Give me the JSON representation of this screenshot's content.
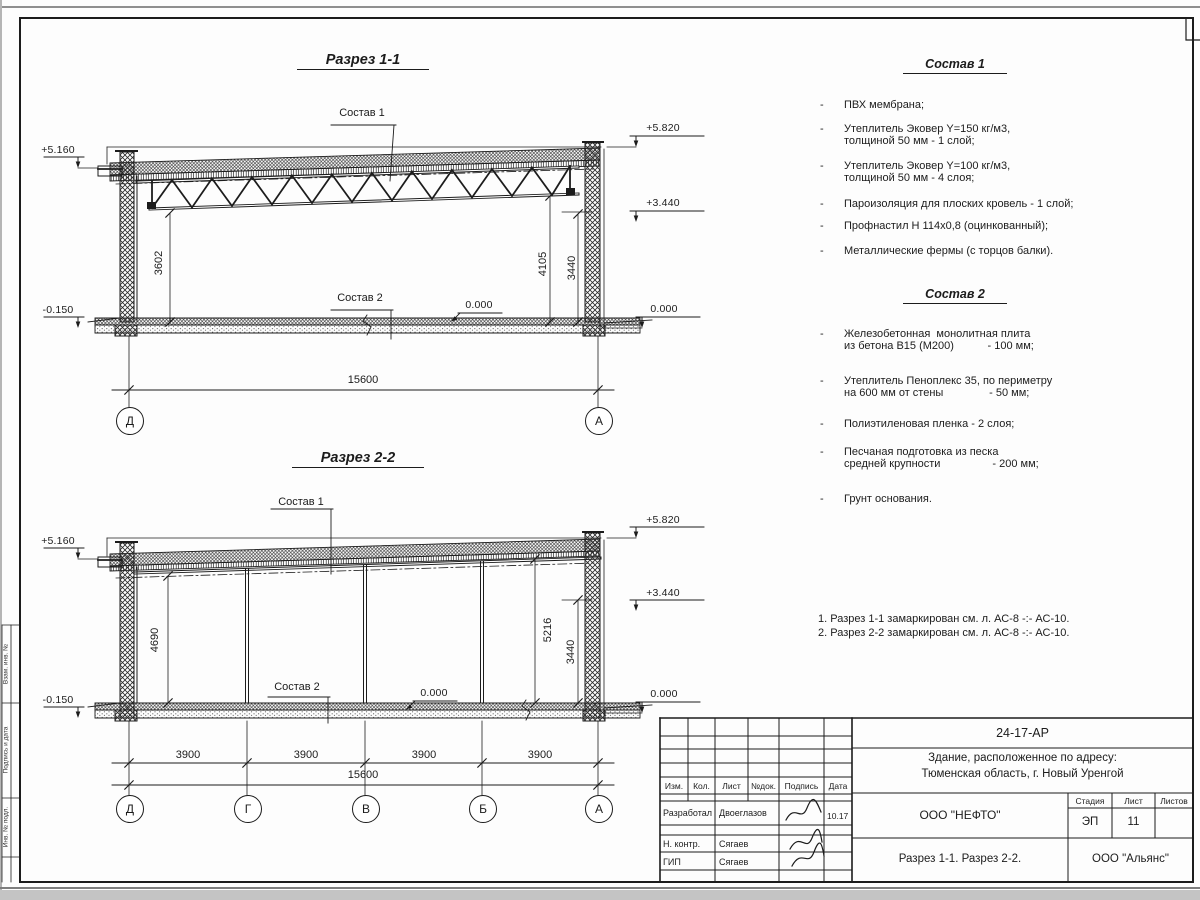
{
  "frame": {
    "side_labels": [
      "Взам. инв. №",
      "Подпись и дата",
      "Инв. № подл."
    ]
  },
  "section1": {
    "title": "Разрез 1-1",
    "sostav1_label": "Состав 1",
    "sostav2_label": "Состав 2",
    "elev_parapet": "+5.160",
    "elev_top": "+5.820",
    "elev_mid": "+3.440",
    "elev_zero": "0.000",
    "elev_floor": "0.000",
    "elev_ground": "-0.150",
    "dim_left": "3602",
    "dim_right_a": "4105",
    "dim_right_b": "3440",
    "dim_total": "15600",
    "axes": [
      "Д",
      "А"
    ]
  },
  "section2": {
    "title": "Разрез 2-2",
    "sostav1_label": "Состав 1",
    "sostav2_label": "Состав 2",
    "elev_parapet": "+5.160",
    "elev_top": "+5.820",
    "elev_mid": "+3.440",
    "elev_zero": "0.000",
    "elev_floor": "0.000",
    "elev_ground": "-0.150",
    "dim_left": "4690",
    "dim_right_a": "5216",
    "dim_right_b": "3440",
    "spans": [
      "3900",
      "3900",
      "3900",
      "3900"
    ],
    "dim_total": "15600",
    "axes": [
      "Д",
      "Г",
      "В",
      "Б",
      "А"
    ]
  },
  "lists": {
    "bullet": "-",
    "sostav1": {
      "title": "Состав 1",
      "items": [
        "ПВХ мембрана;",
        "Утеплитель Эковер Y=150 кг/м3,\nтолщиной 50 мм - 1 слой;",
        "Утеплитель Эковер Y=100 кг/м3,\nтолщиной 50 мм - 4 слоя;",
        "Пароизоляция для плоских кровель - 1 слой;",
        "Профнастил Н 114х0,8 (оцинкованный);",
        "Металлические фермы (с торцов балки)."
      ]
    },
    "sostav2": {
      "title": "Состав 2",
      "items": [
        "Железобетонная  монолитная плита\nиз бетона В15 (М200)           - 100 мм;",
        "Утеплитель Пеноплекс 35, по периметру\nна 600 мм от стены               - 50 мм;",
        "Полиэтиленовая пленка - 2 слоя;",
        "Песчаная подготовка из песка\nсредней крупности                 - 200 мм;",
        "Грунт основания."
      ]
    }
  },
  "notes": [
    "1. Разрез 1-1 замаркирован см. л. АС-8 -:- АС-10.",
    "2. Разрез 2-2 замаркирован см. л. АС-8 -:- АС-10."
  ],
  "titleblock": {
    "doc_number": "24-17-АР",
    "project_line1": "Здание, расположенное по адресу:",
    "project_line2": "Тюменская область, г. Новый Уренгой",
    "columns": [
      "Изм.",
      "Кол.",
      "Лист",
      "№док.",
      "Подпись",
      "Дата"
    ],
    "rows": [
      {
        "role": "Разработал",
        "name": "Двоеглазов",
        "date": "10.17"
      },
      {
        "role": "Н. контр.",
        "name": "Сягаев",
        "date": ""
      },
      {
        "role": "ГИП",
        "name": "Сягаев",
        "date": ""
      }
    ],
    "company": "ООО \"НЕФТО\"",
    "stage_label": "Стадия",
    "sheet_label": "Лист",
    "sheets_label": "Листов",
    "stage": "ЭП",
    "sheet_number": "11",
    "sheet_title": "Разрез 1-1. Разрез 2-2.",
    "contractor": "ООО \"Альянс\""
  }
}
